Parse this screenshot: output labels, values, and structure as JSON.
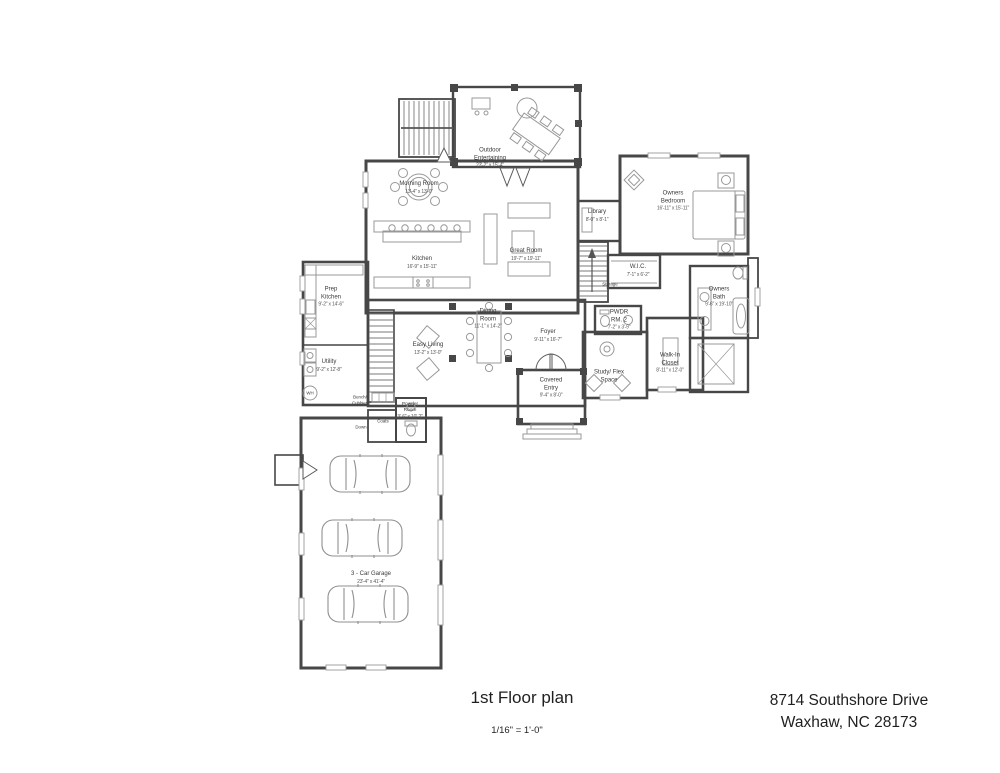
{
  "footer": {
    "title": "1st Floor plan",
    "scale": "1/16\" = 1'-0\"",
    "address_line1": "8714 Southshore Drive",
    "address_line2": "Waxhaw, NC 28173"
  },
  "plan": {
    "colors": {
      "wall": "#474747",
      "furniture": "#989898",
      "text": "#3a3a3a"
    },
    "rooms": [
      {
        "name": "Outdoor Entertaining",
        "dims": "23'-2\" x 15'-4\""
      },
      {
        "name": "Morning Room",
        "dims": "13'-4\" x 13'-0\""
      },
      {
        "name": "Kitchen",
        "dims": "16'-9\" x 15'-11\""
      },
      {
        "name": "Prep Kitchen",
        "dims": "9'-2\" x 14'-6\""
      },
      {
        "name": "Great Room",
        "dims": "19'-7\" x 19'-11\""
      },
      {
        "name": "Library",
        "dims": "8'-0\" x 8'-1\""
      },
      {
        "name": "Owners Bedroom",
        "dims": "16'-11\" x 15'-11\""
      },
      {
        "name": "W.I.C.",
        "dims": "7'-1\" x 6'-2\""
      },
      {
        "name": "Owners Bath",
        "dims": "9'-6\" x 19'-10\""
      },
      {
        "name": "PWDR RM. 2",
        "dims": "7'-2\" x 3'-9\""
      },
      {
        "name": "Storage",
        "dims": ""
      },
      {
        "name": "Dining Room",
        "dims": "11'-1\" x 14'-2\""
      },
      {
        "name": "Foyer",
        "dims": "9'-11\" x 16'-7\""
      },
      {
        "name": "Study/ Flex Space",
        "dims": ""
      },
      {
        "name": "Walk-In Closet",
        "dims": "8'-11\" x 12'-0\""
      },
      {
        "name": "Covered Entry",
        "dims": "9'-4\" x 8'-0\""
      },
      {
        "name": "Easy Living",
        "dims": "13'-2\" x 13'-0\""
      },
      {
        "name": "Utility",
        "dims": "9'-2\" x 12'-8\""
      },
      {
        "name": "Bench/ Cubbies",
        "dims": ""
      },
      {
        "name": "Powder Room",
        "dims": "3'-6\" x 10'-2\""
      },
      {
        "name": "Coats",
        "dims": ""
      },
      {
        "name": "3 - Car Garage",
        "dims": "23'-4\" x 41'-4\""
      }
    ],
    "annotations": {
      "water_heater": "WH",
      "stair_down": "Down"
    }
  }
}
